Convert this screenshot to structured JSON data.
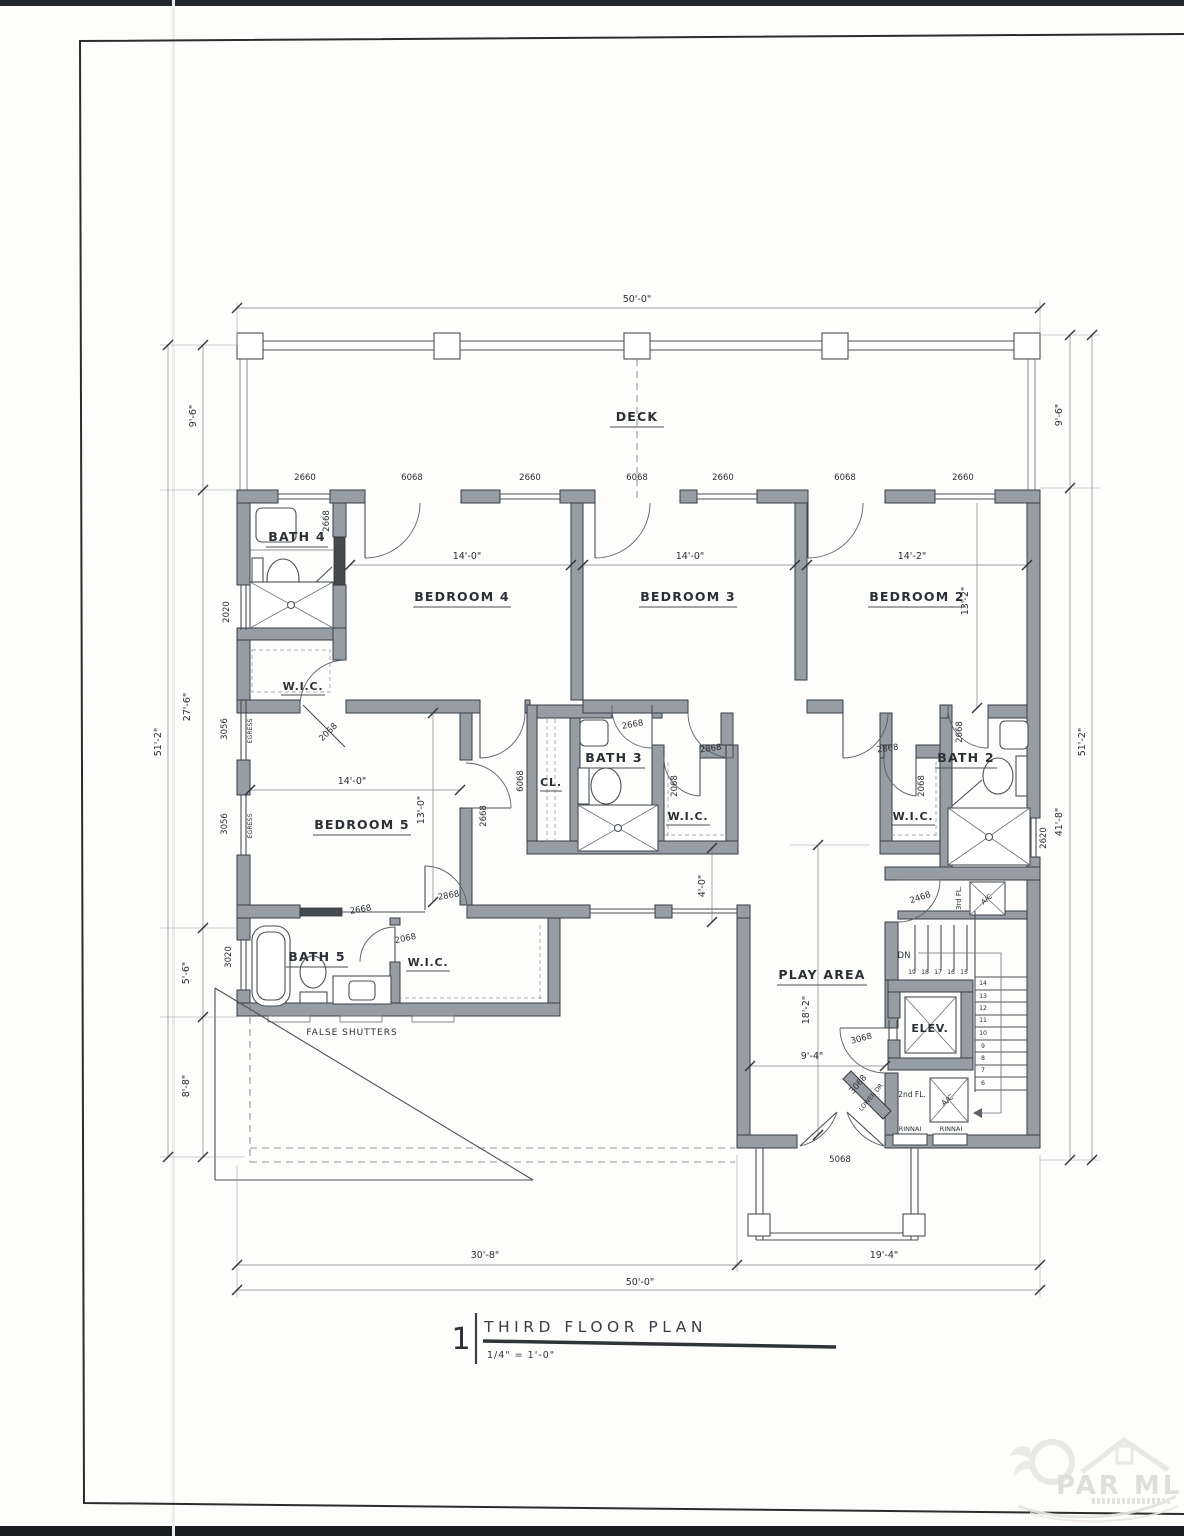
{
  "sheet": {
    "number": "1",
    "title": "THIRD FLOOR PLAN",
    "scale": "1/4\" = 1'-0\""
  },
  "rooms": {
    "deck": "DECK",
    "bedroom4": "BEDROOM 4",
    "bedroom3": "BEDROOM 3",
    "bedroom2": "BEDROOM 2",
    "bedroom5": "BEDROOM 5",
    "bath4": "BATH 4",
    "bath3": "BATH 3",
    "bath2": "BATH 2",
    "bath5": "BATH 5",
    "wic": "W.I.C.",
    "closet": "CL.",
    "play": "PLAY AREA",
    "elevator": "ELEV."
  },
  "dims": {
    "overall_width": "50'-0\"",
    "deck_depth": "9'-6\"",
    "overall_height": "51'-2\"",
    "left_mid": "27'-6\"",
    "left_bath5": "5'-6\"",
    "left_roof": "8'-8\"",
    "right_main": "41'-8\"",
    "bed4_width": "14'-0\"",
    "bed3_width": "14'-0\"",
    "bed2_width": "14'-2\"",
    "bed2_depth": "13'-2\"",
    "bed5_width": "14'-0\"",
    "bed5_depth": "13'-0\"",
    "hall": "4'-0\"",
    "play_depth": "18'-2\"",
    "play_width": "9'-4\"",
    "bottom_left": "30'-8\"",
    "bottom_right": "19'-4\"",
    "bottom_overall": "50'-0\""
  },
  "openings": {
    "w2660": "2660",
    "d6068": "6068",
    "d2668": "2668",
    "d2068": "2068",
    "d2868": "2868",
    "d2468": "2468",
    "d3068": "3068",
    "d5068": "5068",
    "w3056": "3056",
    "w3020": "3020",
    "w2020": "2020",
    "w2620": "2620"
  },
  "notes": {
    "egress": "EGRESS",
    "false_shutters": "FALSE SHUTTERS",
    "dn": "DN",
    "third_fl": "3rd FL.",
    "second_fl": "2nd FL.",
    "ac": "A/C",
    "rinnai": "RINNAI",
    "lower_dr": "LOWER DR."
  },
  "stairs": {
    "treads": [
      "19",
      "18",
      "17",
      "16",
      "15",
      "14",
      "13",
      "12",
      "11",
      "10",
      "9",
      "8",
      "7",
      "6"
    ]
  },
  "watermark": {
    "brand": "PAR MLS"
  }
}
